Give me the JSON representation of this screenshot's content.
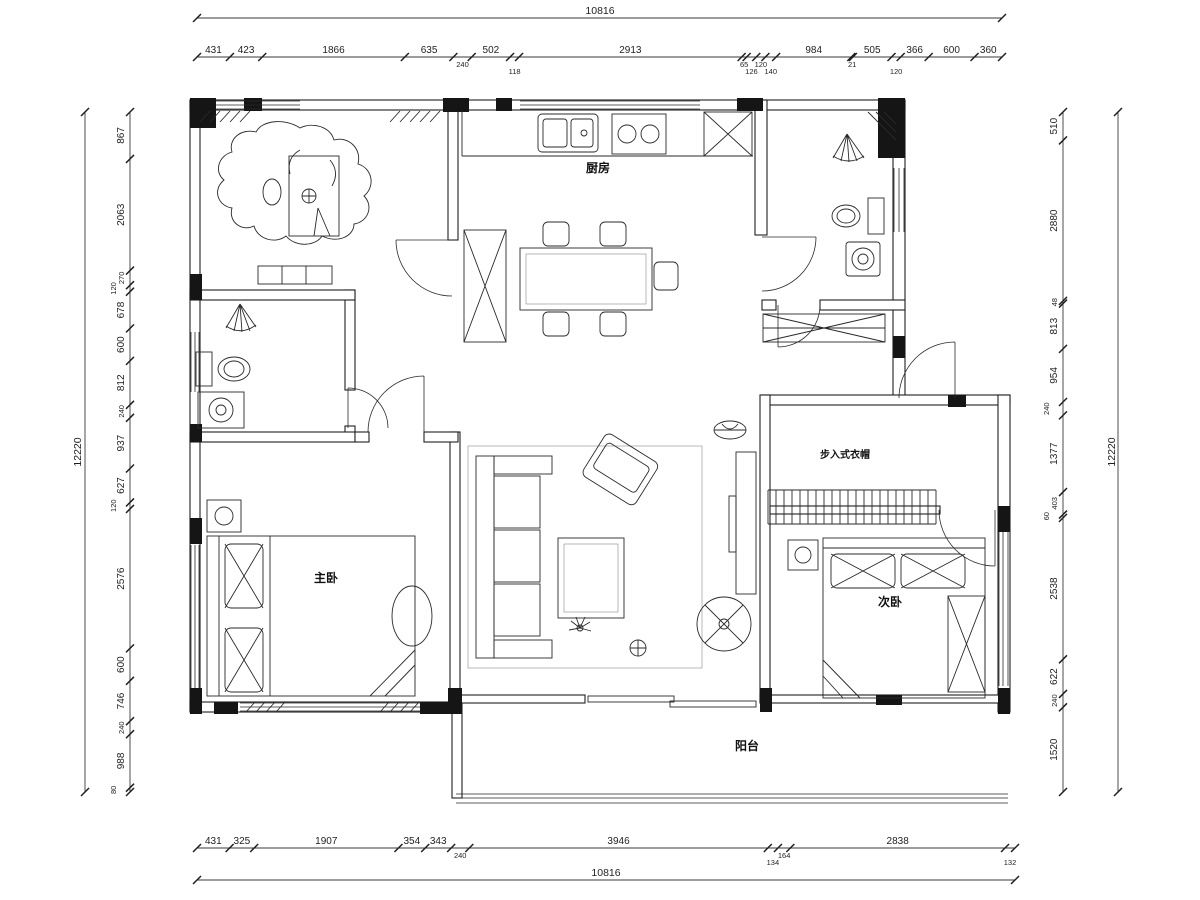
{
  "rooms": {
    "kitchen": "厨房",
    "master_bedroom": "主卧",
    "second_bedroom": "次卧",
    "balcony": "阳台",
    "walk_in_closet": "步入式衣帽"
  },
  "dims": {
    "top_total": "10816",
    "bottom_total": "10816",
    "left_total": "12220",
    "right_total": "12220",
    "top": [
      "431",
      "423",
      "1866",
      "635",
      "240",
      "502",
      "118",
      "2913",
      "65",
      "126",
      "120",
      "140",
      "984",
      "21",
      "505",
      "120",
      "366",
      "600",
      "360"
    ],
    "left": [
      "867",
      "2063",
      "270",
      "120",
      "678",
      "600",
      "812",
      "240",
      "937",
      "627",
      "120",
      "2576",
      "600",
      "746",
      "240",
      "988",
      "80"
    ],
    "right": [
      "510",
      "2880",
      "48",
      "813",
      "954",
      "240",
      "1377",
      "403",
      "60",
      "2538",
      "622",
      "240",
      "1520"
    ],
    "bottom": [
      "431",
      "325",
      "1907",
      "354",
      "343",
      "240",
      "3946",
      "134",
      "164",
      "2838",
      "132"
    ]
  },
  "colors": {
    "line": "#1f1f1f",
    "wall_fill": "#151515",
    "background": "#ffffff"
  }
}
